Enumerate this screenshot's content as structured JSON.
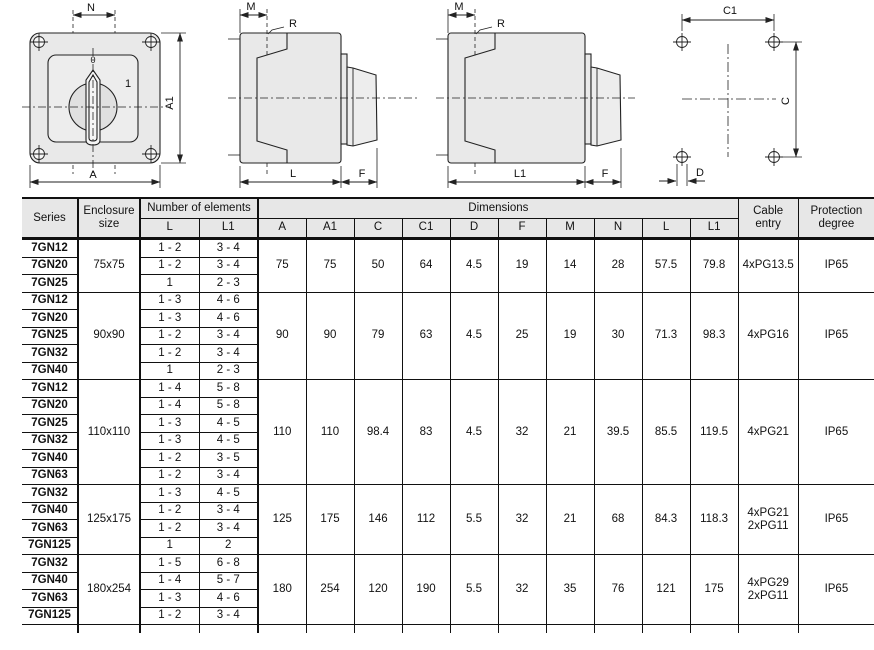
{
  "colors": {
    "line": "#222222",
    "body_fill": "#e9e9e9",
    "knob_fill": "#e0e0e0",
    "header_bg": "#e7e7e7"
  },
  "drawings": {
    "front_view": {
      "dim_n": "N",
      "dim_a1": "A1",
      "dim_a": "A",
      "pos_0": "0",
      "pos_1": "1"
    },
    "side_view_l": {
      "dim_m": "M",
      "dim_r": "R",
      "dim_l": "L",
      "dim_f": "F"
    },
    "side_view_l1": {
      "dim_m": "M",
      "dim_r": "R",
      "dim_l1": "L1",
      "dim_f": "F"
    },
    "drilling_template": {
      "dim_c1": "C1",
      "dim_c": "C",
      "dim_d": "D"
    }
  },
  "table": {
    "headers": {
      "series": "Series",
      "enclosure": "Enclosure\nsize",
      "elements": "Number of elements",
      "dimensions": "Dimensions",
      "cable": "Cable\nentry",
      "protection": "Protection\ndegree",
      "sub": [
        "L",
        "L1",
        "A",
        "A1",
        "C",
        "C1",
        "D",
        "F",
        "M",
        "N",
        "L",
        "L1"
      ]
    },
    "groups": [
      {
        "enclosure": "75x75",
        "rows": [
          [
            "7GN12",
            "1 - 2",
            "3 - 4"
          ],
          [
            "7GN20",
            "1 - 2",
            "3 - 4"
          ],
          [
            "7GN25",
            "1",
            "2 - 3"
          ]
        ],
        "dims": [
          "75",
          "75",
          "50",
          "64",
          "4.5",
          "19",
          "14",
          "28",
          "57.5",
          "79.8"
        ],
        "cable": "4xPG13.5",
        "protection": "IP65"
      },
      {
        "enclosure": "90x90",
        "rows": [
          [
            "7GN12",
            "1 - 3",
            "4 - 6"
          ],
          [
            "7GN20",
            "1 - 3",
            "4 - 6"
          ],
          [
            "7GN25",
            "1 - 2",
            "3 - 4"
          ],
          [
            "7GN32",
            "1 - 2",
            "3 - 4"
          ],
          [
            "7GN40",
            "1",
            "2 - 3"
          ]
        ],
        "dims": [
          "90",
          "90",
          "79",
          "63",
          "4.5",
          "25",
          "19",
          "30",
          "71.3",
          "98.3"
        ],
        "cable": "4xPG16",
        "protection": "IP65"
      },
      {
        "enclosure": "110x110",
        "rows": [
          [
            "7GN12",
            "1 - 4",
            "5 - 8"
          ],
          [
            "7GN20",
            "1 - 4",
            "5 - 8"
          ],
          [
            "7GN25",
            "1 - 3",
            "4 - 5"
          ],
          [
            "7GN32",
            "1 - 3",
            "4 - 5"
          ],
          [
            "7GN40",
            "1 - 2",
            "3 - 5"
          ],
          [
            "7GN63",
            "1 - 2",
            "3 - 4"
          ]
        ],
        "dims": [
          "110",
          "110",
          "98.4",
          "83",
          "4.5",
          "32",
          "21",
          "39.5",
          "85.5",
          "119.5"
        ],
        "cable": "4xPG21",
        "protection": "IP65"
      },
      {
        "enclosure": "125x175",
        "rows": [
          [
            "7GN32",
            "1 - 3",
            "4 - 5"
          ],
          [
            "7GN40",
            "1 - 2",
            "3 - 4"
          ],
          [
            "7GN63",
            "1 - 2",
            "3 - 4"
          ],
          [
            "7GN125",
            "1",
            "2"
          ]
        ],
        "dims": [
          "125",
          "175",
          "146",
          "112",
          "5.5",
          "32",
          "21",
          "68",
          "84.3",
          "118.3"
        ],
        "cable": "4xPG21\n2xPG11",
        "protection": "IP65"
      },
      {
        "enclosure": "180x254",
        "rows": [
          [
            "7GN32",
            "1 - 5",
            "6 - 8"
          ],
          [
            "7GN40",
            "1 - 4",
            "5 - 7"
          ],
          [
            "7GN63",
            "1 - 3",
            "4 - 6"
          ],
          [
            "7GN125",
            "1 - 2",
            "3 - 4"
          ]
        ],
        "dims": [
          "180",
          "254",
          "120",
          "190",
          "5.5",
          "32",
          "35",
          "76",
          "121",
          "175"
        ],
        "cable": "4xPG29\n2xPG11",
        "protection": "IP65"
      }
    ]
  }
}
